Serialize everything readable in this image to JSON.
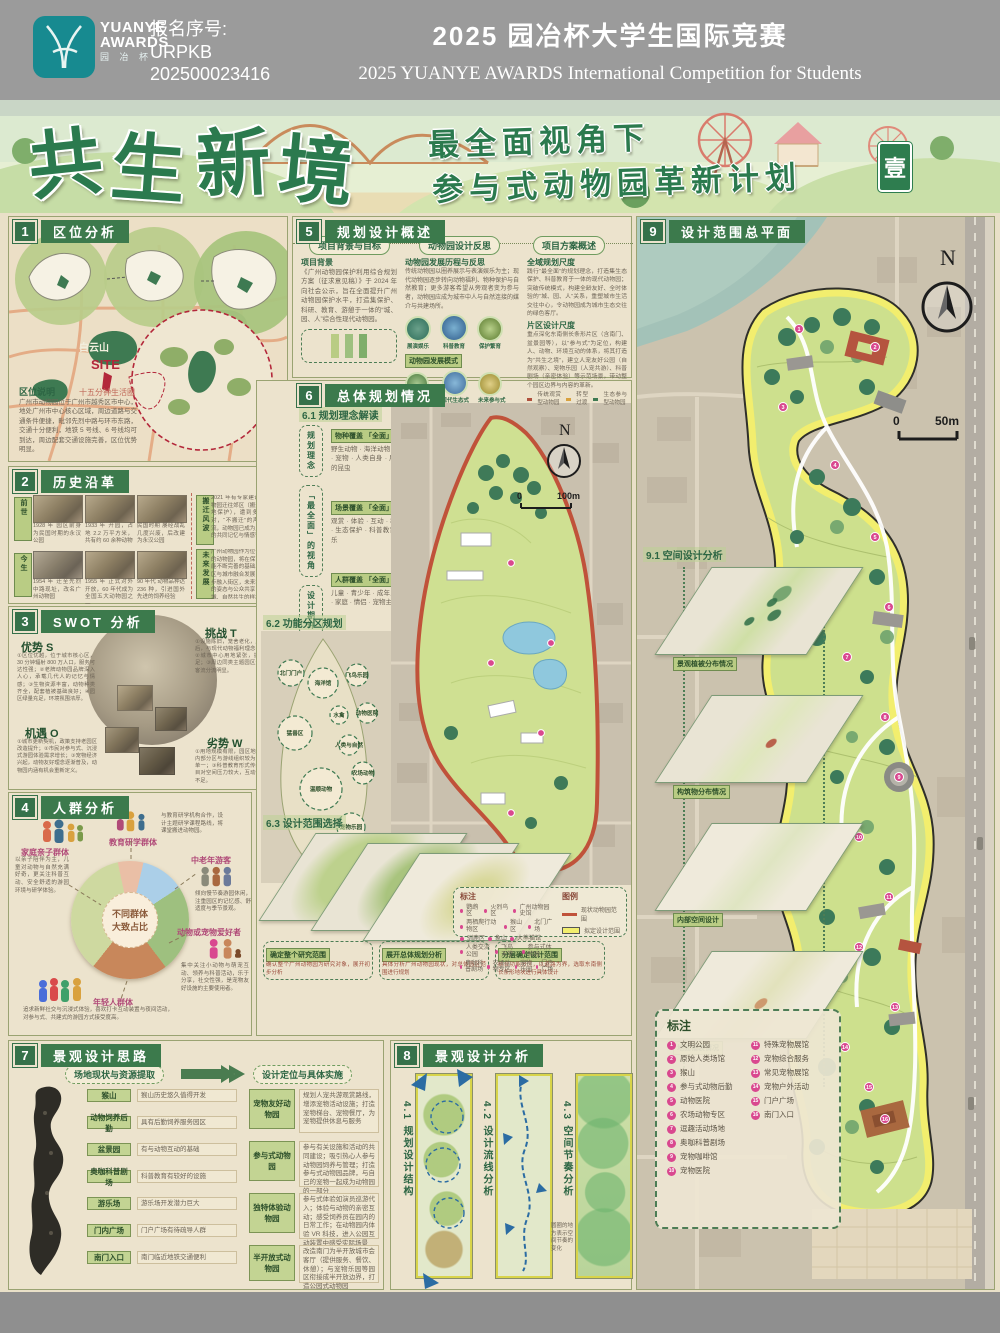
{
  "header": {
    "logo1": "YUANYE",
    "logo2": "AWARDS",
    "logo_cn": "园 冶 杯",
    "reg_label": "报名序号:",
    "reg1": "URPKB",
    "reg2": "202500023416",
    "title_cn": "2025 园冶杯大学生国际竞赛",
    "title_en": "2025 YUANYE AWARDS International Competition for  Students"
  },
  "banner": {
    "t0": "共",
    "t1": "生",
    "t2": "新",
    "t3": "境",
    "sub1": "最全面视角下",
    "sub2": "参与式动物园革新计划",
    "seal": "壹"
  },
  "s1": {
    "num": "1",
    "title": "区位分析",
    "mountain": "白云山",
    "site": "SITE",
    "ring": "十五分钟生活圈",
    "note_title": "区位说明",
    "note": "广州市动物园位于广州市越秀区市中心，地处广州市中心核心区域，周边道路与交通条件便捷，毗邻先烈中路与环市东路，交通十分便利，地铁 5 号线、6 号线均可到达，周边配套交通设施完善，区位优势明显。"
  },
  "s2": {
    "num": "2",
    "title": "历史沿革",
    "tag_past": "前世",
    "tag_now": "今生",
    "tag_storm": "搬迁风波",
    "tag_future": "未来发展",
    "past": [
      "1928 年 园区前身为民国时期的永汉公园",
      "1933 年 开园，占地 2.2 万平方米，共有约 60 余种动物",
      "民国时期 屡经战乱几度兴废，后改建为永汉公园"
    ],
    "now": [
      "1954 年 迁至先烈中路现址，改名广州动物园",
      "1955 年 正式对外开放，60 年代成为全国五大动物园之一",
      "90 年代 动物品种达 236 种，引进国外先进的饲养经验"
    ],
    "storm": "2021 年有专家建议将广州动物园迁往郊区（搬迁扩容、异地保护），遭到多数市民反对，“不搬迁”的声音占据主流，动物园已成为几代广州人的共同记忆与情感寄托。",
    "future": "广州动物园作为位于城市中心的动物园，将在保育与科普功能不断完善的基础上，推动园区与城市融合发展，近年已逐步融入街区，未来将以更开放的姿态与公众共享，成为人、城、自然共生的样本。"
  },
  "s3": {
    "num": "3",
    "title": "SWOT 分析",
    "s": "优势 S",
    "t": "挑战 T",
    "o": "机遇 O",
    "w": "劣势 W",
    "s_text": "①区位优越，位于城市核心区，30 分钟辐射 800 万人口，服务可达性强；②老牌动物园品牌深入人心，承载几代人的记忆与情感；③生物资源丰富，动物种类齐全，配套植被基础良好；④园区绿量充足，环境氛围浓厚。",
    "t_text": "①设施陈旧，笼舍老化，展示模式落后，与现代动物福利理念存在差距；②城市中心用地紧张，扩展空间不足；③周边同类主题园区竞争激烈，客流分流明显。",
    "o_text": "①城市更新契机，政策支持老园区改造提升；②市民对参与式、沉浸式游园体验需求增长；③宠物经济兴起，动物友好理念逐渐普及，动物园内涵有机会重新定义。",
    "w_text": "①用地规模有限，园区地块狭长；②内部分区与游线组织较为混乱，体验单一；③科普教育形式传统，人气项目对空间压力较大，互动性与参与感不足。"
  },
  "s4": {
    "num": "4",
    "title": "人群分析",
    "center1": "不同群体",
    "center2": "大致占比",
    "g_family": "家庭亲子群体",
    "g_edu": "教育研学群体",
    "g_elder": "中老年游客",
    "g_pet": "动物或宠物爱好者",
    "g_young": "年轻人群体",
    "d_family": "以亲子陪伴为主，儿童对动物与自然充满好奇，更关注科普互动、安全舒适的游园环境与研学体验。",
    "d_edu": "与教育研学机构合作，设计主题研学课程路线，将课堂搬进动物园。",
    "d_elder": "倾向慢节奏游园休闲，注重园区的记忆感、舒适度与季节景观。",
    "d_pet": "集中关注小动物与萌宠互动、领养与科普活动，乐于分享，社交性强，是宠物友好设施的主要使用者。",
    "d_young": "追求新鲜社交与沉浸式体验，喜欢打卡互动装置与夜间活动，对参与式、共建式的游园方式接受度高。",
    "chart_data": {
      "type": "pie",
      "title": "不同群体大致占比",
      "labels": [
        "教育研学群体",
        "中老年游客",
        "动物或宠物爱好者",
        "年轻人群体",
        "家庭亲子群体"
      ],
      "values": [
        7,
        12,
        24,
        21,
        36
      ],
      "colors": [
        "#eabfa6",
        "#abcfe8",
        "#9ec07f",
        "#c8875b",
        "#ced9a0"
      ]
    }
  },
  "s5": {
    "num": "5",
    "title": "规划设计概述",
    "pill1": "项目背景与目标",
    "pill2": "动物园设计反思",
    "pill3": "项目方案概述",
    "bg_title": "项目背景",
    "bg": "《广州动物园保护利用综合规划方案（征求意见稿）》于 2024 年向社会公示，旨在全面提升广州动物园保护水平，打造集保护、科研、教育、游憩于一体的“城、园、人”综合性现代动物园。",
    "re_title": "动物园发展历程与反思",
    "re": "传统动物园以圈养展示与表演娱乐为主；现代动物园逐步转向动物福利、物种保护与自然教育；更多游客希望从旁观者变为参与者，动物园应成为城市中人与自然连接的媒介与共建场所。",
    "c1": "展演娱乐",
    "c2": "科普教育",
    "c3": "保护繁育",
    "mode": "动物园发展模式",
    "m1": "传统圈养式",
    "m2": "现代生态式",
    "m3": "未来参与式",
    "sc1_title": "全域规划尺度",
    "sc1": "践行“最全面”的规划理念，打造集生态保护、科普教育于一体的现代动物园；突破传统模式，构建全龄友好、全时体验的“城、园、人”关系，重塑城市生活交往中心，令动物园成为城市生态交往的绿色客厅。",
    "sc2_title": "片区设计尺度",
    "sc2": "重点深化东南侧长条形片区（含南门、盆景园等），以“参与式”为定位，构建人、动物、环境互动的体系，将其打造为“共生之境”，建立人宠友好公园（自然观察）、宠物乐园（人宠共游）、科普剧场（亲密体验）等示范场景，带动整个园区边界与内容的革新。",
    "lg1": "传统观赏型动物园",
    "lg2": "转型过渡",
    "lg3": "生态参与型动物园"
  },
  "s6": {
    "num": "6",
    "title": "总体规划情况",
    "s61": "6.1 规划理念解读",
    "side1": "规划理念",
    "side2": "「最全面」的视角",
    "side3": "设计期许",
    "b1_title": "物种覆盖 「全面」",
    "b1": "野生动物 · 海洋动物 · 农场动物 · 宠物 · 人类自身 · 展演园区中的昆虫",
    "b2_title": "场景覆盖 「全面」",
    "b2": "观赏 · 体验 · 互动 · 教育 · 休闲 · 生态保护 · 科普教育 · 休闲娱乐",
    "b3_title": "人群覆盖 「全面」",
    "b3": "儿童 · 青少年 · 成年人 · 老年人 · 家庭 · 情侣 · 宠物主人",
    "compass": "N",
    "scale0": "0",
    "scale1": "100m",
    "s62": "6.2 功能分区规划",
    "bubbles": [
      "北门门户",
      "海洋馆",
      "飞鸟乐园",
      "水禽",
      "动物医院",
      "猛兽区",
      "人类与自然",
      "农场动物",
      "温顺动物",
      "宠物乐园",
      "南门门户"
    ],
    "s63": "6.3 设计范围选择",
    "step1": "确定整个研究范围",
    "step1d": "确认整个广州动物园为研究对象，展开初步分析",
    "step2": "展开总体规划分析",
    "step2d": "具体分析广州动物园现状，对总体园区范围进行规划",
    "step3": "分层确定设计范围",
    "step3d": "结合功能分区，以道路为界，选取东南侧长条形地块进行具体设计",
    "mark_title": "标注",
    "marks_a": [
      "鹦鹉区",
      "火烈鸟区",
      "广州动物园史馆",
      "两栖爬行动物区",
      "猴山区",
      "北门广场",
      "驯鹿区",
      "象山",
      "大熊猫馆",
      "人类交流公园"
    ],
    "marks_b": [
      "飞鸟天堂",
      "参与式体验园",
      "奥咖科普剧场",
      "农场动物专区",
      "宠物乐园",
      "门户广场"
    ],
    "legend_title": "图例",
    "lg1": "现状动物园范围",
    "lg2": "拟定设计范围"
  },
  "s7": {
    "num": "7",
    "title": "景观设计思路",
    "col1": "场地现状与资源提取",
    "col2": "设计定位与具体实施",
    "l0": "猴山",
    "l0d": "猴山历史悠久值得开发",
    "l1": "动物饲养后勤",
    "l1d": "具有后勤饲养服务园区",
    "l2": "盆景园",
    "l2d": "有与动物互动的基础",
    "l3": "奥咖科普剧场",
    "l3d": "科普教育有较好的设施",
    "l4": "游乐场",
    "l4d": "游乐场开发潜力巨大",
    "l5": "门内广场",
    "l5d": "门户广场有待疏导人群",
    "l6": "南门入口",
    "l6d": "南门临近地铁交通便利",
    "r0": "宠物友好动物园",
    "r0d": "规划人宠共游观赏路线，增添宠物活动设施；打造宠物梯台、宠物餐厅，为宠物提供休息与服务",
    "r1": "参与式动物园",
    "r1d": "参与有关设施和活动的共同建设；吸引热心人参与动物园饲养与管理；打造参与式动物园品牌，与自己的宠物一起成为动物园的一部分",
    "r2": "独特体验动物园",
    "r2d": "参与式体验如演员巡游代入；体验与动物的亲密互动；感受饲养员在园内的日常工作；在动物园内体验 VR 科技，进入公园互动装置中感受实际场景",
    "r3": "半开放式动物园",
    "r3d": "改造南门为半开放城市会客厅（提供服务、餐饮、休憩）；与宠物乐园等园区衔接成半开放边界，打造公园式动物园"
  },
  "s8": {
    "num": "8",
    "title": "景观设计分析",
    "a": "4.1 规划设计结构",
    "b": "4.2 设计流线分析",
    "c": "4.3 空间节奏分析",
    "note": "圆圈的地方表示空间节奏的变化"
  },
  "s9": {
    "num": "9",
    "title": "设计范围总平面",
    "compass": "N",
    "scale0": "0",
    "scale1": "50m",
    "s91": "9.1 空间设计分析",
    "layers": [
      "景观植被分布情况",
      "构筑物分布情况",
      "内部空间设计",
      "地面铺装情况"
    ],
    "mark_title": "标注",
    "marks": [
      {
        "n": "1",
        "t": "文明公园"
      },
      {
        "n": "2",
        "t": "原始人类场馆"
      },
      {
        "n": "3",
        "t": "猴山"
      },
      {
        "n": "4",
        "t": "参与式动物后勤"
      },
      {
        "n": "5",
        "t": "动物医院"
      },
      {
        "n": "6",
        "t": "农场动物专区"
      },
      {
        "n": "7",
        "t": "逗趣活动场地"
      },
      {
        "n": "8",
        "t": "奥咖科普剧场"
      },
      {
        "n": "9",
        "t": "宠物咖啡馆"
      },
      {
        "n": "10",
        "t": "宠物医院"
      },
      {
        "n": "11",
        "t": "特殊宠物展馆"
      },
      {
        "n": "12",
        "t": "宠物综合服务"
      },
      {
        "n": "13",
        "t": "常见宠物展馆"
      },
      {
        "n": "14",
        "t": "宠物户外活动"
      },
      {
        "n": "15",
        "t": "门户广场"
      },
      {
        "n": "16",
        "t": "南门入口"
      }
    ],
    "markers": [
      "1",
      "2",
      "3",
      "4",
      "5",
      "6",
      "7",
      "8",
      "9",
      "10",
      "11",
      "12",
      "13",
      "14",
      "15",
      "16"
    ]
  }
}
